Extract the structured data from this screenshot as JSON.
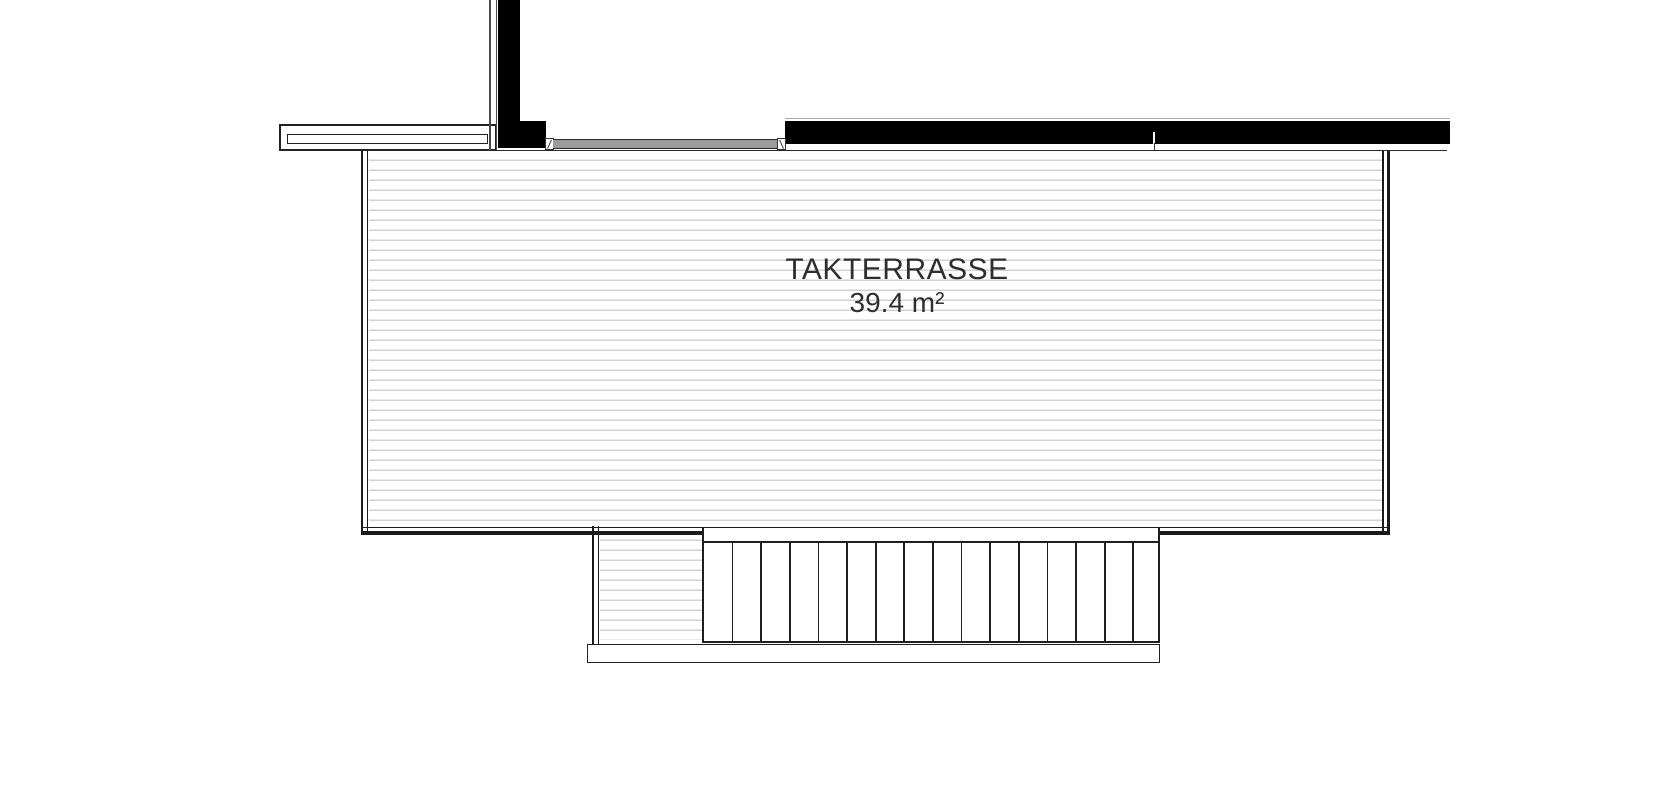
{
  "drawing": {
    "type": "architectural floor plan (roof terrace)",
    "room": {
      "name": "TAKTERRASSE",
      "area_label": "39.4 m²"
    },
    "stairs": {
      "treads": 16,
      "riser_lines": 15
    },
    "colors": {
      "background": "#ffffff",
      "wall_fill": "#000000",
      "line_dark": "#1f1f1f",
      "deck_hatch": "#d2d2d2",
      "window_glazing": "#9c9c9c",
      "label_text": "#2e2e2e"
    }
  }
}
